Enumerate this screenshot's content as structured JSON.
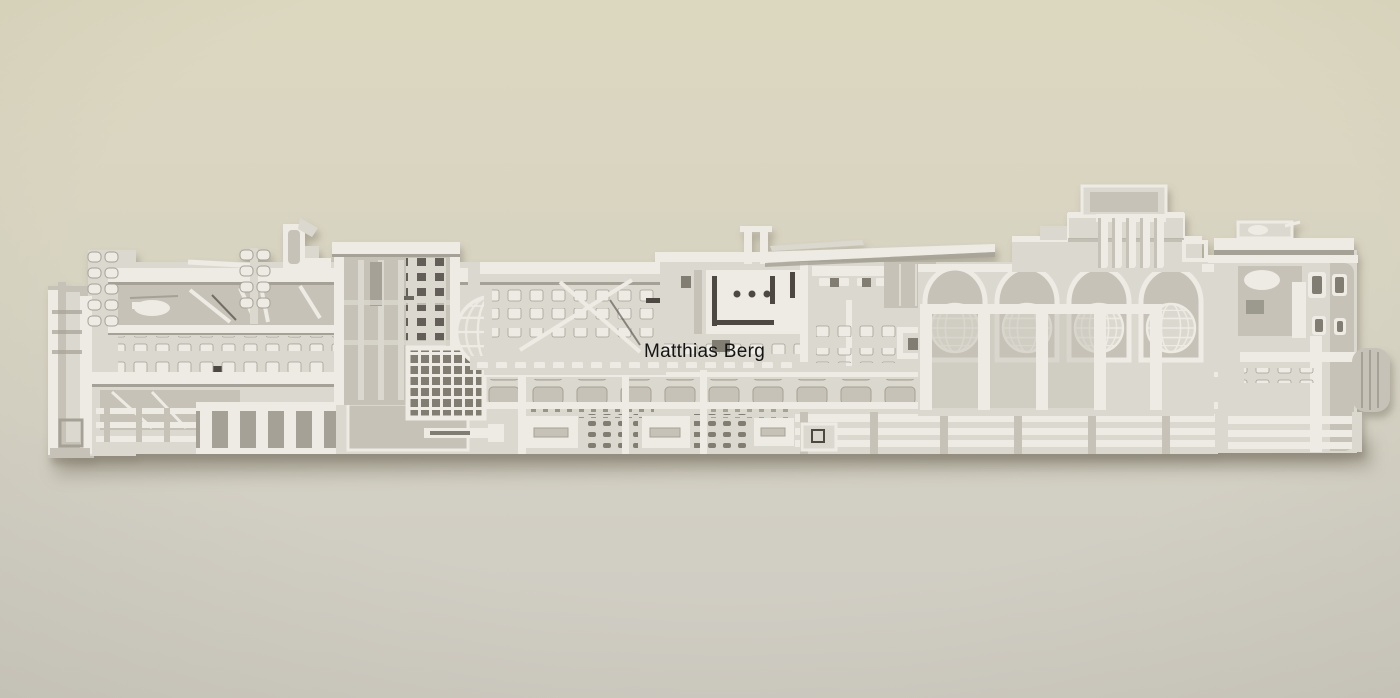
{
  "photo": {
    "description": "Photograph of a long, highly detailed 3D-printed white architectural cross-section relief sculpture mounted horizontally on a beige wall, casting a soft shadow",
    "watermark": {
      "text": "Matthias Berg",
      "color": "#141414"
    }
  },
  "colors": {
    "wall_top": "#dcd8c0",
    "wall_bottom": "#cfccc3",
    "relief_highlight": "#edebe4",
    "relief_body": "#dbd8cf",
    "relief_shade": "#c6c2b7",
    "relief_deep_shade": "#a5a196",
    "relief_recess": "#817d73",
    "relief_dark": "#4e4a43",
    "cast_shadow": "#6e6857",
    "watermark": "#141414"
  }
}
